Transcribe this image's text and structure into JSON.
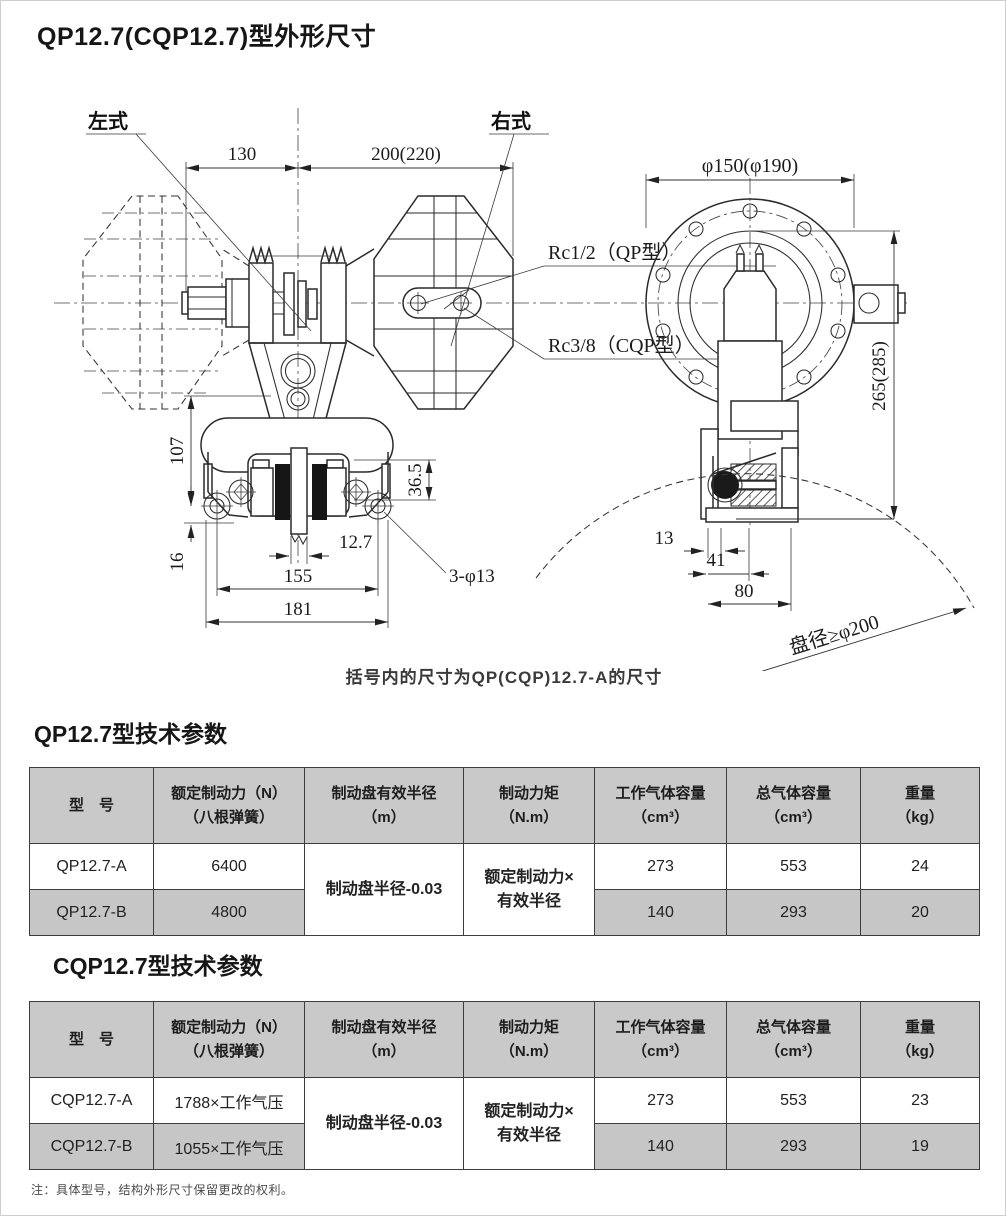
{
  "page": {
    "title": "QP12.7(CQP12.7)型外形尺寸",
    "caption": "括号内的尺寸为QP(CQP)12.7-A的尺寸",
    "footnote": "注：具体型号，结构外形尺寸保留更改的权利。"
  },
  "drawing": {
    "labels": {
      "left_type": "左式",
      "right_type": "右式",
      "rc_qp": "Rc1/2（QP型）",
      "rc_cqp": "Rc3/8（CQP型）",
      "disc_dia": "盘径≥φ200"
    },
    "dims": {
      "w130": "130",
      "w200": "200(220)",
      "dia150": "φ150(φ190)",
      "h265": "265(285)",
      "h107": "107",
      "h16": "16",
      "h36_5": "36.5",
      "t12_7": "12.7",
      "w155": "155",
      "w181": "181",
      "holes": "3-φ13",
      "d13": "13",
      "d41": "41",
      "d80": "80"
    }
  },
  "table1": {
    "title": "QP12.7型技术参数",
    "headers": [
      {
        "l1": "型　号",
        "l2": ""
      },
      {
        "l1": "额定制动力（N）",
        "l2": "（八根弹簧）"
      },
      {
        "l1": "制动盘有效半径",
        "l2": "（m）"
      },
      {
        "l1": "制动力矩",
        "l2": "（N.m）"
      },
      {
        "l1": "工作气体容量",
        "l2": "（cm³）"
      },
      {
        "l1": "总气体容量",
        "l2": "（cm³）"
      },
      {
        "l1": "重量",
        "l2": "（kg）"
      }
    ],
    "merged": {
      "radius": "制动盘半径-0.03",
      "torque1": "额定制动力×",
      "torque2": "有效半径"
    },
    "rows": [
      {
        "model": "QP12.7-A",
        "force": "6400",
        "work": "273",
        "total": "553",
        "weight": "24"
      },
      {
        "model": "QP12.7-B",
        "force": "4800",
        "work": "140",
        "total": "293",
        "weight": "20"
      }
    ]
  },
  "table2": {
    "title": "CQP12.7型技术参数",
    "headers": [
      {
        "l1": "型　号",
        "l2": ""
      },
      {
        "l1": "额定制动力（N）",
        "l2": "（八根弹簧）"
      },
      {
        "l1": "制动盘有效半径",
        "l2": "（m）"
      },
      {
        "l1": "制动力矩",
        "l2": "（N.m）"
      },
      {
        "l1": "工作气体容量",
        "l2": "（cm³）"
      },
      {
        "l1": "总气体容量",
        "l2": "（cm³）"
      },
      {
        "l1": "重量",
        "l2": "（kg）"
      }
    ],
    "merged": {
      "radius": "制动盘半径-0.03",
      "torque1": "额定制动力×",
      "torque2": "有效半径"
    },
    "rows": [
      {
        "model": "CQP12.7-A",
        "force": "1788×工作气压",
        "work": "273",
        "total": "553",
        "weight": "23"
      },
      {
        "model": "CQP12.7-B",
        "force": "1055×工作气压",
        "work": "140",
        "total": "293",
        "weight": "19"
      }
    ]
  }
}
